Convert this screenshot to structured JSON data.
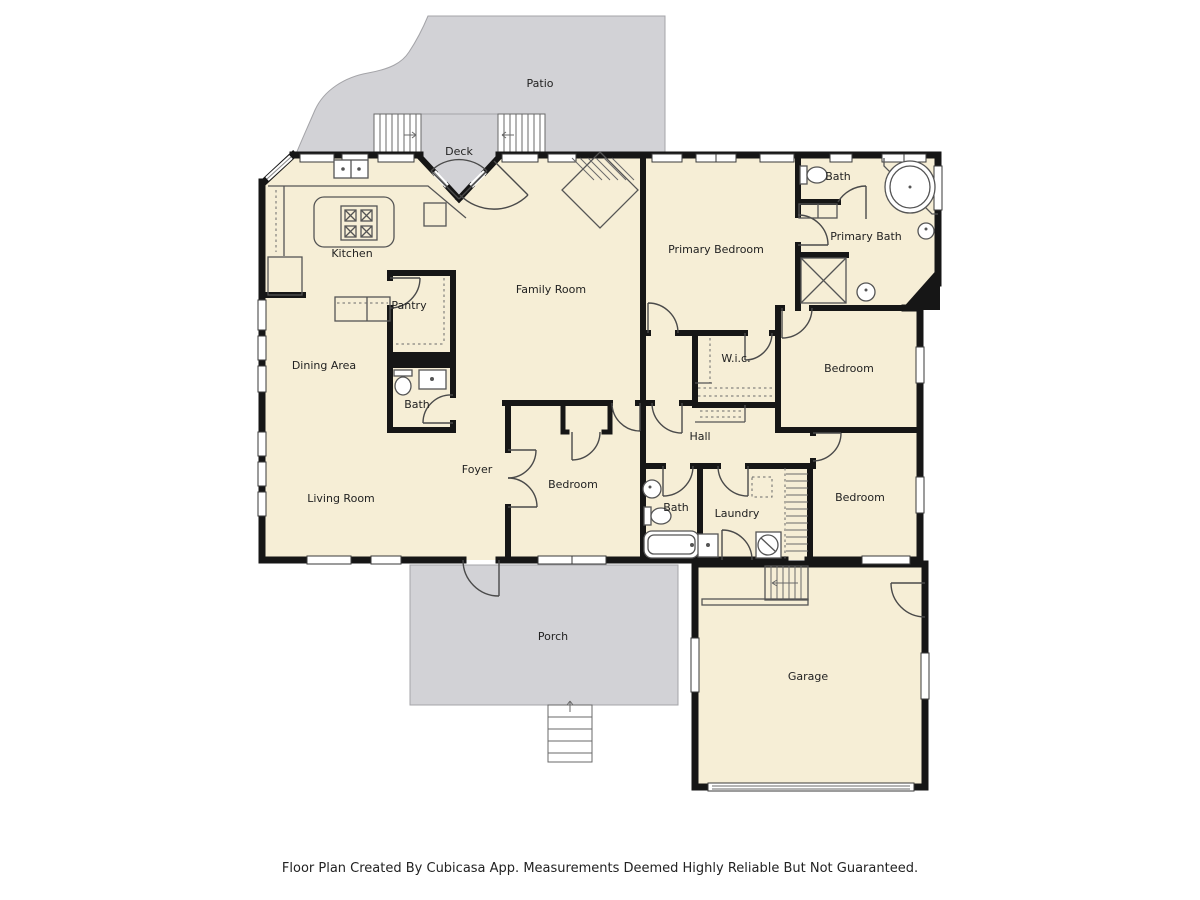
{
  "palette": {
    "room_fill": "#f6eed6",
    "outdoor_fill": "#d2d2d6",
    "wall_color": "#161616",
    "fixture_line_color": "#555555",
    "label_color": "#222222",
    "background": "#ffffff"
  },
  "rooms": {
    "patio": {
      "label": "Patio"
    },
    "deck": {
      "label": "Deck"
    },
    "kitchen": {
      "label": "Kitchen"
    },
    "pantry": {
      "label": "Pantry"
    },
    "family_room": {
      "label": "Family Room"
    },
    "primary_bedroom": {
      "label": "Primary Bedroom"
    },
    "upper_bath": {
      "label": "Bath"
    },
    "primary_bath": {
      "label": "Primary Bath"
    },
    "dining_area": {
      "label": "Dining Area"
    },
    "middle_bath": {
      "label": "Bath"
    },
    "wic": {
      "label": "W.i.c."
    },
    "bedroom_ne": {
      "label": "Bedroom"
    },
    "hall": {
      "label": "Hall"
    },
    "foyer": {
      "label": "Foyer"
    },
    "living_room": {
      "label": "Living Room"
    },
    "bedroom_center": {
      "label": "Bedroom"
    },
    "hall_bath": {
      "label": "Bath"
    },
    "laundry": {
      "label": "Laundry"
    },
    "bedroom_se": {
      "label": "Bedroom"
    },
    "porch": {
      "label": "Porch"
    },
    "garage": {
      "label": "Garage"
    }
  },
  "footer": {
    "text": "Floor Plan Created By Cubicasa App. Measurements Deemed Highly Reliable But Not Guaranteed."
  }
}
